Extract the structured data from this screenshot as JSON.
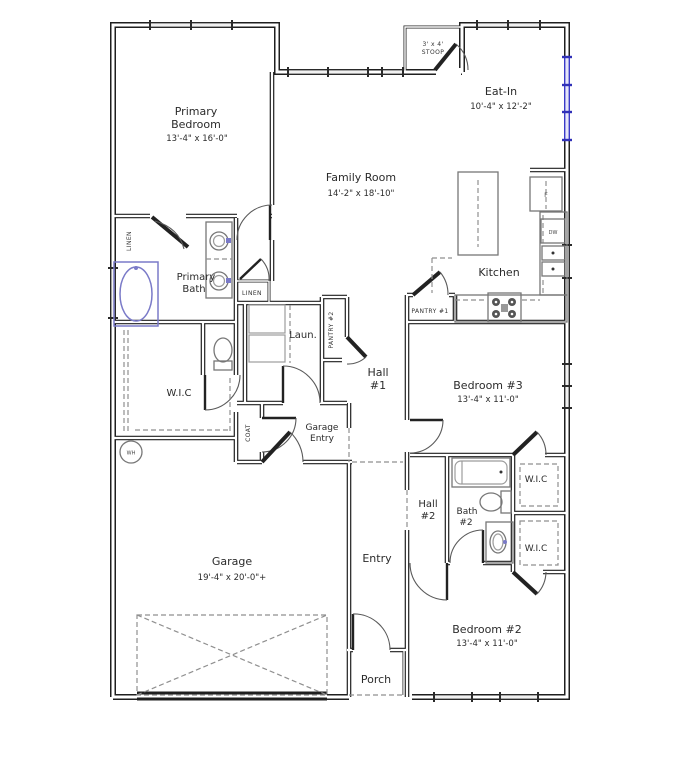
{
  "plan_title": "Single-story residential floor plan",
  "colors": {
    "wall": "#1f1f1f",
    "window_accent_blue": "#3a3ac8",
    "fixture_gray": "#777777",
    "tub_accent_blue": "#7a7ac8"
  },
  "rooms": {
    "primary_bedroom": {
      "line1": "Primary",
      "line2": "Bedroom",
      "dims": "13'-4\" x 16'-0\""
    },
    "family_room": {
      "line1": "Family Room",
      "dims": "14'-2\" x 18'-10\""
    },
    "eat_in": {
      "line1": "Eat-In",
      "dims": "10'-4\" x 12'-2\""
    },
    "stoop": {
      "line1": "3' x 4'",
      "line2": "STOOP"
    },
    "kitchen": {
      "line1": "Kitchen"
    },
    "primary_bath": {
      "line1": "Primary",
      "line2": "Bath"
    },
    "laundry": {
      "line1": "Laun."
    },
    "hall1": {
      "line1": "Hall",
      "line2": "#1"
    },
    "wic_primary": {
      "line1": "W.I.C"
    },
    "garage_entry": {
      "line1": "Garage",
      "line2": "Entry"
    },
    "bedroom3": {
      "line1": "Bedroom #3",
      "dims": "13'-4\" x 11'-0\""
    },
    "hall2": {
      "line1": "Hall",
      "line2": "#2"
    },
    "bath2": {
      "line1": "Bath",
      "line2": "#2"
    },
    "wic_upper": {
      "line1": "W.I.C"
    },
    "wic_lower": {
      "line1": "W.I.C"
    },
    "garage": {
      "line1": "Garage",
      "dims": "19'-4\" x 20'-0\"+"
    },
    "entry": {
      "line1": "Entry"
    },
    "porch": {
      "line1": "Porch"
    },
    "bedroom2": {
      "line1": "Bedroom #2",
      "dims": "13'-4\" x 11'-0\""
    }
  },
  "closets": {
    "linen_bath": "LINEN",
    "linen_hall": "LINEN",
    "pantry1": "PANTRY #1",
    "pantry2": "PANTRY #2",
    "coat": "COAT"
  },
  "appliances": {
    "fridge": "F",
    "dishwasher": "DW",
    "water_heater": "WH"
  }
}
